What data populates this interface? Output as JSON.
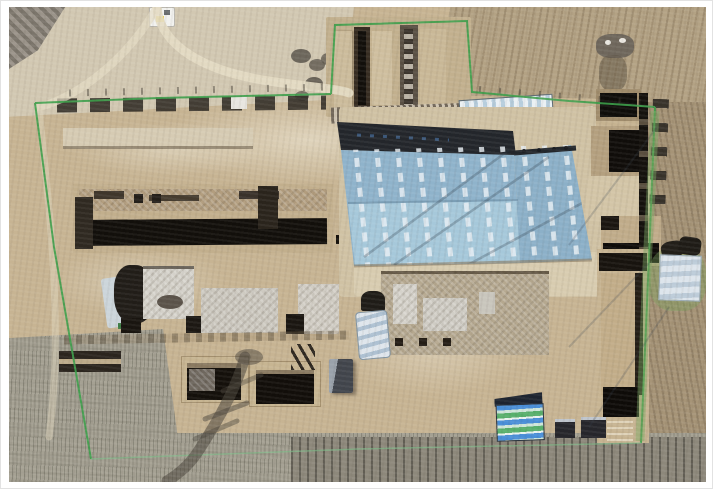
{
  "scene": {
    "type": "aerial drone photograph",
    "subject": "archaeological excavation site: fenced compound with a large blue protective shelter roof, excavation trenches and pits, tarp-covered mounds, and surrounding plowed and stubble farmland",
    "visible_text": "none"
  },
  "colors": {
    "frame_border": "#e2e2e2",
    "sand_base": "#c7b493",
    "sand_light": "#d6cbb3",
    "field_grey": "#d2c8b2",
    "field_tilled": "#b3a284",
    "field_tilled_dark": "#a69477",
    "stubble": "#a5a193",
    "furrow_dark": "#8d887b",
    "roof_blue": "#8fb3cb",
    "roof_blue_light": "#a6c8da",
    "roof_blue_right": "#8cb0c8",
    "roof_dark_band": "#23262b",
    "skylight": "#e8f0f5",
    "fence_green": "#3da04b",
    "fence_green_faint": "#7ec08a",
    "trench_black": "#120f0b",
    "trench_wall": "#9b8767",
    "spoil_tan": "#ccbc9c",
    "plaster_grey": "#d3d0c8",
    "excavation_mottled": "#b5a88f",
    "tarp_white": "#dde5ec",
    "tarp_blue": "#4a8fd8",
    "tarp_green": "#58b06c",
    "shed_dark": "#41454c",
    "shed_light": "#9aa2ab",
    "shadow_dark": "#4b463d",
    "apron_concrete": "#d0c2a4"
  },
  "features": [
    {
      "name": "shelter-roof",
      "label": "large blue steel shelter roof with skylight strips"
    },
    {
      "name": "roof-shadow-band",
      "label": "dark shaded band at top edge of roof"
    },
    {
      "name": "perimeter-fence",
      "label": "green mesh perimeter fence"
    },
    {
      "name": "trench-block-north",
      "label": "two long excavation trenches with spoil mounds"
    },
    {
      "name": "long-trench-west",
      "label": "long east-west excavation trench with dark shadowed bottom"
    },
    {
      "name": "deep-pits-east",
      "label": "deep square excavation pits with shadowed walls"
    },
    {
      "name": "long-trench-southeast",
      "label": "long north-south trench near east fence"
    },
    {
      "name": "plaster-floors",
      "label": "whitish excavated building floor remains"
    },
    {
      "name": "storage-tent",
      "label": "dark tarp-covered tent over a mound"
    },
    {
      "name": "tarp-covered-mound",
      "label": "white-blue tarp covered spoil mounds"
    },
    {
      "name": "striped-tarp",
      "label": "blue and green striped tarp"
    },
    {
      "name": "equipment-shed",
      "label": "small grey equipment shed"
    },
    {
      "name": "pylon-shadow",
      "label": "shadow of a transmission pylon on stubble field"
    },
    {
      "name": "work-vehicle",
      "label": "small white-yellow vehicle on access road"
    },
    {
      "name": "dirt-road",
      "label": "curving dirt access road"
    },
    {
      "name": "fields",
      "label": "surrounding tilled and stubble fields"
    }
  ]
}
